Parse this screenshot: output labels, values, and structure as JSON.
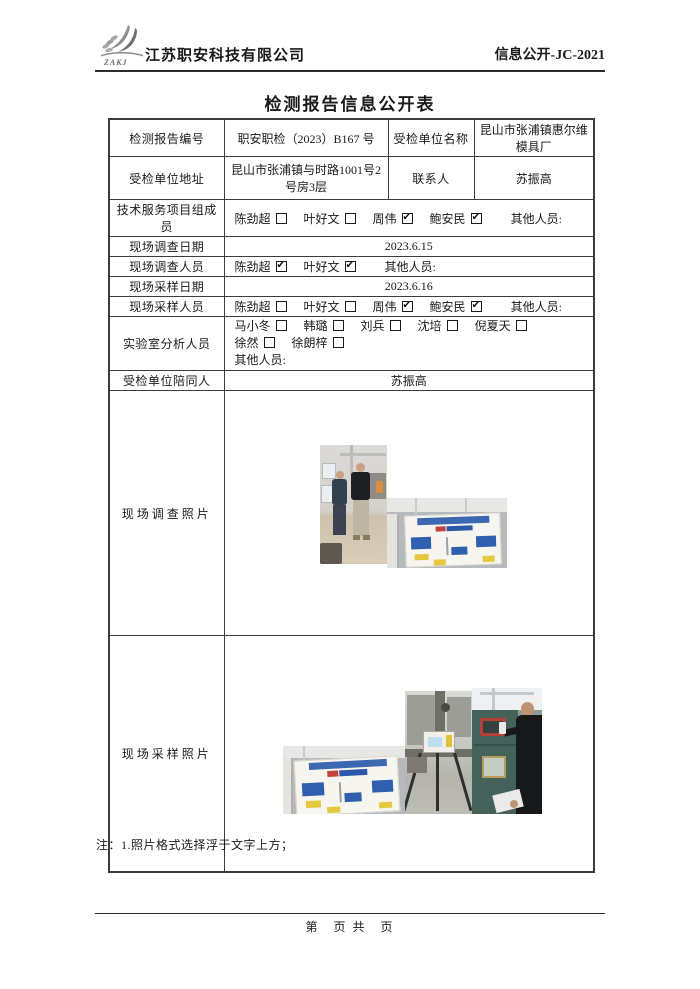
{
  "header": {
    "logo_text": "ZAKJ",
    "company_name": "江苏职安科技有限公司",
    "doc_code": "信息公开-JC-2021"
  },
  "title": "检测报告信息公开表",
  "table": {
    "report_no_label": "检测报告编号",
    "report_no_value": "职安职检（2023）B167 号",
    "unit_name_label": "受检单位名称",
    "unit_name_value": "昆山市张浦镇惠尔维模具厂",
    "unit_addr_label": "受检单位地址",
    "unit_addr_value": "昆山市张浦镇与时路1001号2号房3层",
    "contact_label": "联系人",
    "contact_value": "苏振高",
    "others_label": "其他人员:",
    "tech_team_label": "技术服务项目组成员",
    "tech_team_members": [
      {
        "name": "陈劲超",
        "checked": false
      },
      {
        "name": "叶好文",
        "checked": false
      },
      {
        "name": "周伟",
        "checked": true
      },
      {
        "name": "鲍安民",
        "checked": true
      }
    ],
    "survey_date_label": "现场调查日期",
    "survey_date_value": "2023.6.15",
    "survey_staff_label": "现场调查人员",
    "survey_staff_members": [
      {
        "name": "陈劲超",
        "checked": true
      },
      {
        "name": "叶好文",
        "checked": true
      }
    ],
    "sampling_date_label": "现场采样日期",
    "sampling_date_value": "2023.6.16",
    "sampling_staff_label": "现场采样人员",
    "sampling_staff_members": [
      {
        "name": "陈劲超",
        "checked": false
      },
      {
        "name": "叶好文",
        "checked": false
      },
      {
        "name": "周伟",
        "checked": true
      },
      {
        "name": "鲍安民",
        "checked": true
      }
    ],
    "lab_staff_label": "实验室分析人员",
    "lab_staff_members": [
      {
        "name": "马小冬",
        "checked": false
      },
      {
        "name": "韩璐",
        "checked": false
      },
      {
        "name": "刘兵",
        "checked": false
      },
      {
        "name": "沈培",
        "checked": false
      },
      {
        "name": "倪夏天",
        "checked": false
      },
      {
        "name": "徐然",
        "checked": false
      },
      {
        "name": "徐朗梓",
        "checked": false
      }
    ],
    "companion_label": "受检单位陪同人",
    "companion_value": "苏振高",
    "survey_photo_label": "现场调查照片",
    "sampling_photo_label": "现场采样照片"
  },
  "note": "注：1.照片格式选择浮于文字上方；",
  "footer": {
    "page_text": "第　页 共　页"
  }
}
